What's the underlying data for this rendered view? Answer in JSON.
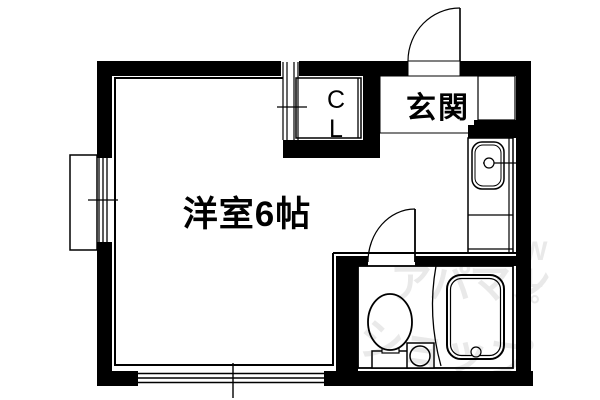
{
  "floorplan": {
    "labels": {
      "room": "洋室6帖",
      "entrance": "玄関",
      "closet": "C\nL"
    },
    "watermark": {
      "line1": "アパマン",
      "line2": "ショップ",
      "side": "W\nL\n°"
    },
    "colors": {
      "wall": "#000000",
      "line": "#000000",
      "background": "#ffffff",
      "watermark": "#e9e9e9"
    }
  }
}
